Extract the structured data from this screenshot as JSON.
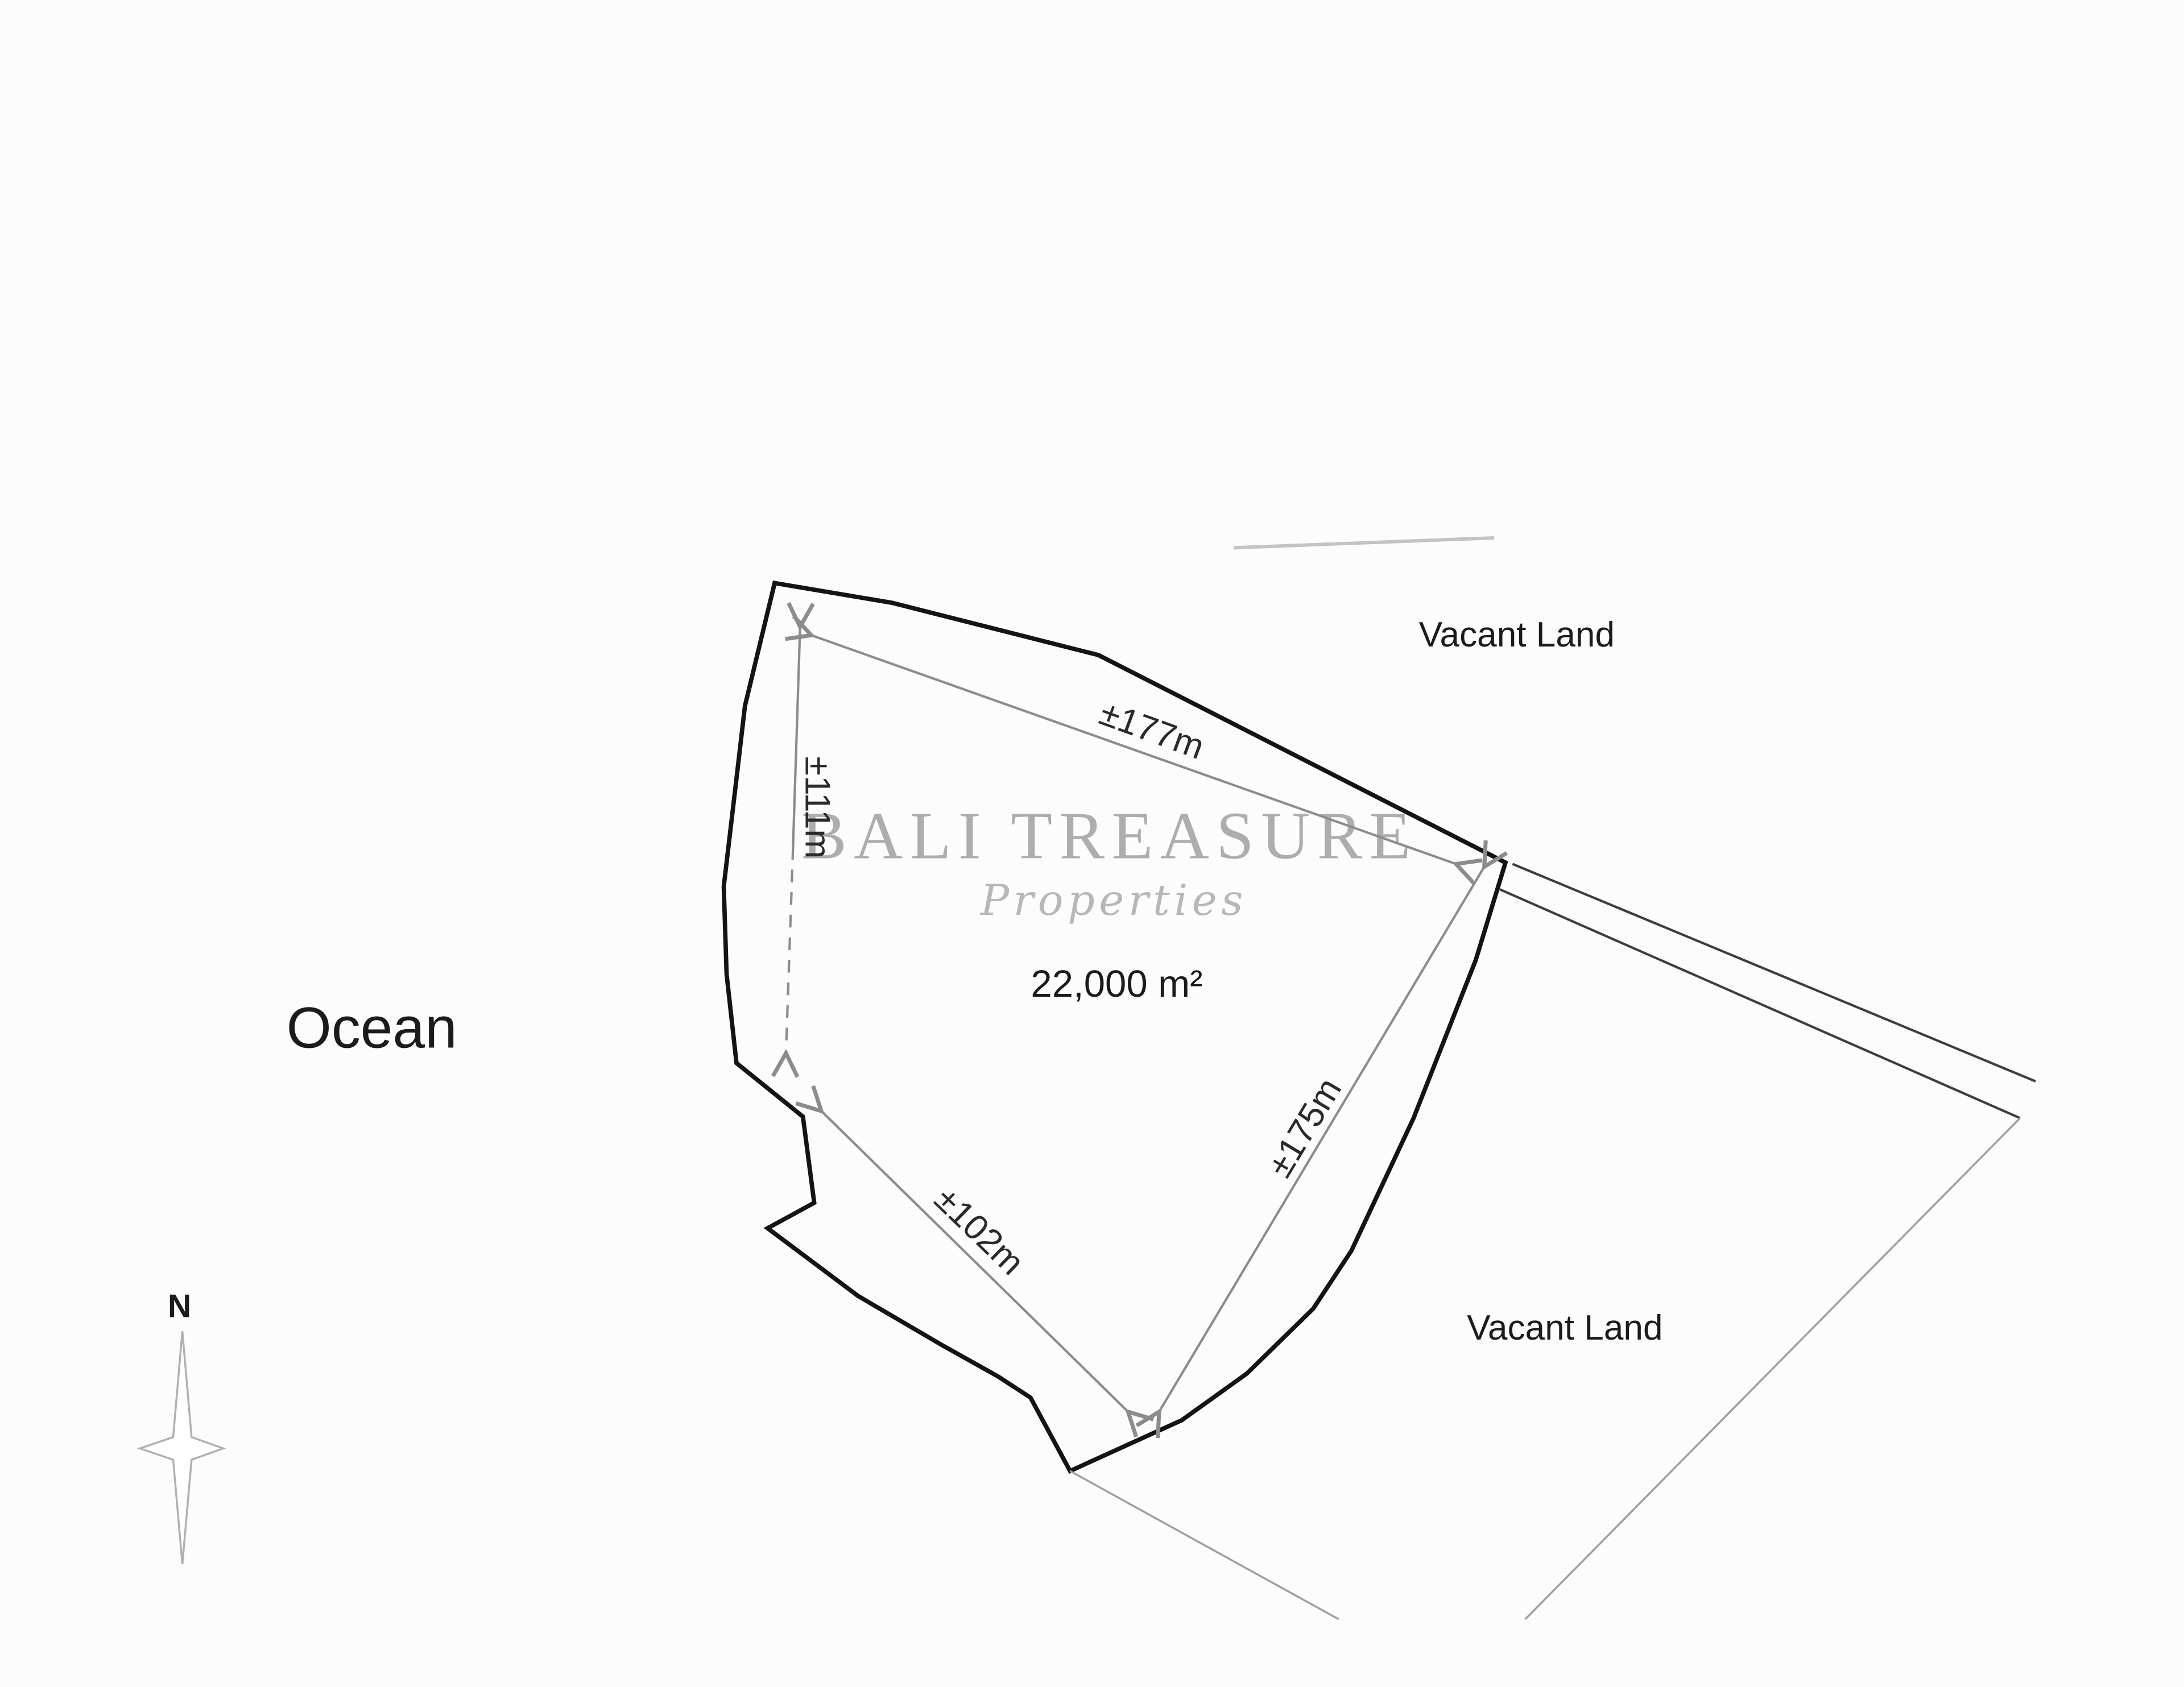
{
  "title": "Land plot survey diagram",
  "labels": {
    "ocean": "Ocean",
    "vacant_land_top": "Vacant Land",
    "vacant_land_bottom": "Vacant Land",
    "area": "22,000 m²",
    "north": "N"
  },
  "dimensions": {
    "top_edge": "±177m",
    "left_edge": "±111m",
    "right_edge": "±175m",
    "bottom_left_edge": "±102m"
  },
  "plot": {
    "area_sqm": "22,000",
    "side_lengths_m": [
      "177",
      "111",
      "175",
      "102"
    ]
  },
  "watermark": {
    "line1": "BALI TREASURE",
    "line2": "Properties"
  },
  "colors": {
    "background": "#fcfcfc",
    "plot_outline": "#141414",
    "dimension_gray": "#8c8c8c",
    "road_line": "#3d3d3d",
    "parcel_line": "#9f9f9f",
    "watermark_gray": "#9c9c9c",
    "text": "#1b1b1b"
  }
}
